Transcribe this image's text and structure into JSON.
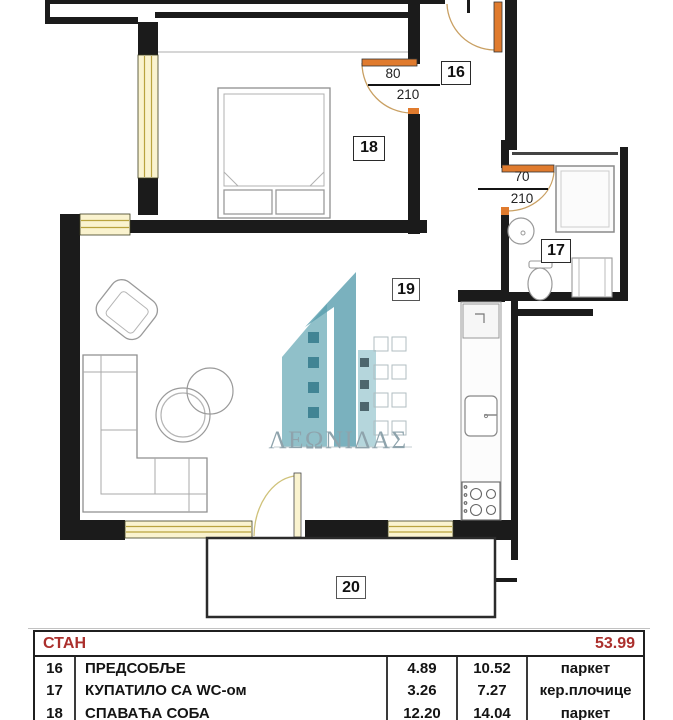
{
  "plan": {
    "watermark_text": "ΛΕΩΝΙΔΑΣ",
    "room_labels": {
      "hall": "16",
      "bath": "17",
      "bedroom": "18",
      "living": "19",
      "terrace": "20"
    },
    "dims": {
      "door_bedroom": {
        "width": "80",
        "height": "210"
      },
      "door_bath": {
        "width": "70",
        "height": "210"
      }
    },
    "colors": {
      "wall": "#1b1b1b",
      "window_fill": "#faf3cf",
      "window_line": "#b9a33e",
      "door_leaf": "#e07b2e",
      "door_arc": "#c9a063",
      "furniture": "#9a9a9a",
      "watermark_teal": "#4b98a8",
      "accent_red": "#ab2f2c"
    }
  },
  "table": {
    "title": "СТАН",
    "total": "53.99",
    "rows": [
      {
        "num": "16",
        "name": "ПРЕДСОБЉЕ",
        "area": "4.89",
        "area2": "10.52",
        "floor": "паркет"
      },
      {
        "num": "17",
        "name": "КУПАТИЛО СА WC-ом",
        "area": "3.26",
        "area2": "7.27",
        "floor": "кер.плочице"
      },
      {
        "num": "18",
        "name": "СПАВАЋА СОБА",
        "area": "12.20",
        "area2": "14.04",
        "floor": "паркет"
      }
    ]
  }
}
